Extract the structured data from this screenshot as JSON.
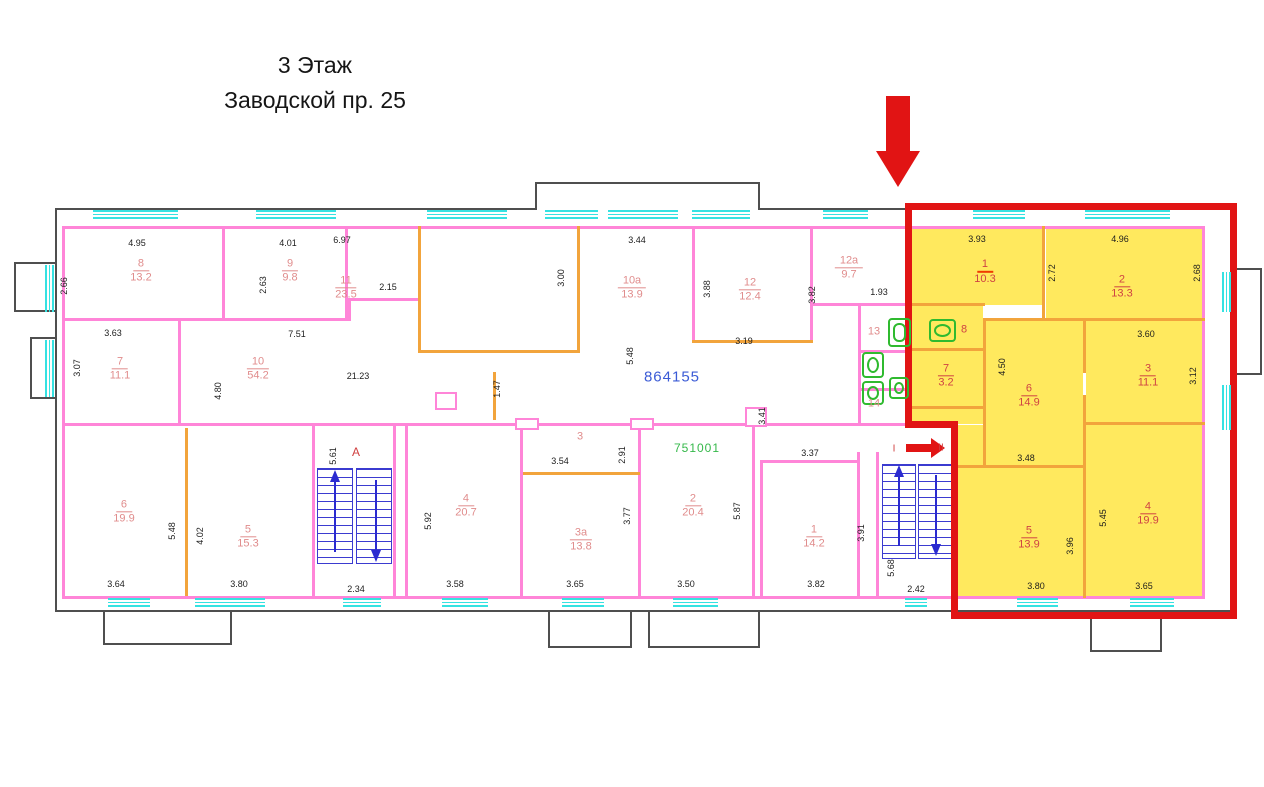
{
  "title": {
    "line1": "3 Этаж",
    "line2": "Заводской пр. 25"
  },
  "refs": {
    "blue": "864155",
    "green": "751001"
  },
  "rooms": [
    {
      "num": "8",
      "area": "13.2",
      "x": 141,
      "y": 271
    },
    {
      "num": "9",
      "area": "9.8",
      "x": 290,
      "y": 271
    },
    {
      "num": "11",
      "area": "23.5",
      "x": 346,
      "y": 288
    },
    {
      "num": "10а",
      "area": "13.9",
      "x": 632,
      "y": 288
    },
    {
      "num": "12",
      "area": "12.4",
      "x": 750,
      "y": 290
    },
    {
      "num": "12а",
      "area": "9.7",
      "x": 849,
      "y": 268
    },
    {
      "num": "13",
      "x": 874,
      "y": 332,
      "noline": true
    },
    {
      "num": "14",
      "x": 874,
      "y": 404,
      "noline": true
    },
    {
      "num": "7",
      "area": "11.1",
      "x": 120,
      "y": 369
    },
    {
      "num": "10",
      "area": "54.2",
      "x": 258,
      "y": 369
    },
    {
      "num": "6",
      "area": "19.9",
      "x": 124,
      "y": 512
    },
    {
      "num": "5",
      "area": "15.3",
      "x": 248,
      "y": 537
    },
    {
      "num": "4",
      "area": "20.7",
      "x": 466,
      "y": 506
    },
    {
      "num": "3",
      "x": 580,
      "y": 437,
      "noline": true
    },
    {
      "num": "3а",
      "area": "13.8",
      "x": 581,
      "y": 540
    },
    {
      "num": "2",
      "area": "20.4",
      "x": 693,
      "y": 506
    },
    {
      "num": "1",
      "area": "14.2",
      "x": 814,
      "y": 537
    },
    {
      "num": "1",
      "area": "10.3",
      "x": 985,
      "y": 272,
      "cls": "redl u-strong"
    },
    {
      "num": "2",
      "area": "13.3",
      "x": 1122,
      "y": 287,
      "cls": "redl"
    },
    {
      "num": "7",
      "area": "3.2",
      "x": 946,
      "y": 376,
      "cls": "redl"
    },
    {
      "num": "6",
      "area": "14.9",
      "x": 1029,
      "y": 396,
      "cls": "redl"
    },
    {
      "num": "3",
      "area": "11.1",
      "x": 1148,
      "y": 376,
      "cls": "redl"
    },
    {
      "num": "5",
      "area": "13.9",
      "x": 1029,
      "y": 538,
      "cls": "redl"
    },
    {
      "num": "4",
      "area": "19.9",
      "x": 1148,
      "y": 514,
      "cls": "redl"
    },
    {
      "num": "8",
      "x": 964,
      "y": 330,
      "noline": true,
      "cls": "redl"
    }
  ],
  "dims": [
    {
      "t": "4.95",
      "x": 137,
      "y": 243
    },
    {
      "t": "2.66",
      "x": 64,
      "y": 286,
      "v": true
    },
    {
      "t": "4.01",
      "x": 288,
      "y": 243
    },
    {
      "t": "2.63",
      "x": 263,
      "y": 285,
      "v": true
    },
    {
      "t": "2.15",
      "x": 388,
      "y": 287
    },
    {
      "t": "6.97",
      "x": 342,
      "y": 240
    },
    {
      "t": "3.00",
      "x": 561,
      "y": 278,
      "v": true
    },
    {
      "t": "3.44",
      "x": 637,
      "y": 240
    },
    {
      "t": "3.88",
      "x": 707,
      "y": 289,
      "v": true
    },
    {
      "t": "3.82",
      "x": 812,
      "y": 295,
      "v": true
    },
    {
      "t": "1.93",
      "x": 879,
      "y": 292
    },
    {
      "t": "3.19",
      "x": 744,
      "y": 341
    },
    {
      "t": "3.63",
      "x": 113,
      "y": 333
    },
    {
      "t": "3.07",
      "x": 77,
      "y": 368,
      "v": true
    },
    {
      "t": "7.51",
      "x": 297,
      "y": 334
    },
    {
      "t": "21.23",
      "x": 358,
      "y": 376
    },
    {
      "t": "4.80",
      "x": 218,
      "y": 391,
      "v": true
    },
    {
      "t": "5.48",
      "x": 630,
      "y": 356,
      "v": true
    },
    {
      "t": "1.47",
      "x": 497,
      "y": 389,
      "v": true
    },
    {
      "t": "3.41",
      "x": 762,
      "y": 416,
      "v": true
    },
    {
      "t": "3.37",
      "x": 810,
      "y": 453
    },
    {
      "t": "3.54",
      "x": 560,
      "y": 461
    },
    {
      "t": "2.91",
      "x": 622,
      "y": 455,
      "v": true
    },
    {
      "t": "3.77",
      "x": 627,
      "y": 516,
      "v": true
    },
    {
      "t": "5.92",
      "x": 428,
      "y": 521,
      "v": true
    },
    {
      "t": "5.48",
      "x": 172,
      "y": 531,
      "v": true
    },
    {
      "t": "4.02",
      "x": 200,
      "y": 536,
      "v": true
    },
    {
      "t": "5.61",
      "x": 333,
      "y": 456,
      "v": true
    },
    {
      "t": "3.64",
      "x": 116,
      "y": 584
    },
    {
      "t": "3.80",
      "x": 239,
      "y": 584
    },
    {
      "t": "2.34",
      "x": 356,
      "y": 589
    },
    {
      "t": "3.58",
      "x": 455,
      "y": 584
    },
    {
      "t": "3.65",
      "x": 575,
      "y": 584
    },
    {
      "t": "3.50",
      "x": 686,
      "y": 584
    },
    {
      "t": "3.82",
      "x": 816,
      "y": 584
    },
    {
      "t": "3.91",
      "x": 861,
      "y": 533,
      "v": true
    },
    {
      "t": "5.87",
      "x": 737,
      "y": 511,
      "v": true
    },
    {
      "t": "5.68",
      "x": 891,
      "y": 568,
      "v": true
    },
    {
      "t": "2.42",
      "x": 916,
      "y": 589
    },
    {
      "t": "3.93",
      "x": 977,
      "y": 239
    },
    {
      "t": "2.72",
      "x": 1052,
      "y": 273,
      "v": true
    },
    {
      "t": "4.96",
      "x": 1120,
      "y": 239
    },
    {
      "t": "2.68",
      "x": 1197,
      "y": 273,
      "v": true
    },
    {
      "t": "3.60",
      "x": 1146,
      "y": 334
    },
    {
      "t": "3.12",
      "x": 1193,
      "y": 376,
      "v": true
    },
    {
      "t": "4.50",
      "x": 1002,
      "y": 367,
      "v": true
    },
    {
      "t": "3.48",
      "x": 1026,
      "y": 458
    },
    {
      "t": "3.96",
      "x": 1070,
      "y": 546,
      "v": true
    },
    {
      "t": "5.45",
      "x": 1103,
      "y": 518,
      "v": true
    },
    {
      "t": "3.80",
      "x": 1036,
      "y": 586
    },
    {
      "t": "3.65",
      "x": 1144,
      "y": 586
    }
  ],
  "texts": [
    {
      "t": "А",
      "x": 356,
      "y": 452,
      "cls": "t-red"
    },
    {
      "t": "I",
      "x": 894,
      "y": 449,
      "cls": "t-red-sm"
    },
    {
      "t": "II",
      "x": 941,
      "y": 448,
      "cls": "t-red-sm"
    },
    {
      "t": "864155",
      "x": 672,
      "y": 377,
      "cls": "t-blue"
    },
    {
      "t": "751001",
      "x": 697,
      "y": 448,
      "cls": "t-green"
    }
  ],
  "windows": [
    {
      "x": 93,
      "y": 210,
      "w": 85
    },
    {
      "x": 256,
      "y": 210,
      "w": 80
    },
    {
      "x": 427,
      "y": 210,
      "w": 80
    },
    {
      "x": 545,
      "y": 210,
      "w": 53
    },
    {
      "x": 608,
      "y": 210,
      "w": 70
    },
    {
      "x": 692,
      "y": 210,
      "w": 58
    },
    {
      "x": 823,
      "y": 210,
      "w": 45
    },
    {
      "x": 973,
      "y": 210,
      "w": 52
    },
    {
      "x": 1085,
      "y": 210,
      "w": 85
    },
    {
      "x": 108,
      "y": 598,
      "w": 42
    },
    {
      "x": 195,
      "y": 598,
      "w": 70
    },
    {
      "x": 343,
      "y": 598,
      "w": 38
    },
    {
      "x": 442,
      "y": 598,
      "w": 46
    },
    {
      "x": 562,
      "y": 598,
      "w": 42
    },
    {
      "x": 673,
      "y": 598,
      "w": 45
    },
    {
      "x": 905,
      "y": 598,
      "w": 22
    },
    {
      "x": 1017,
      "y": 598,
      "w": 41
    },
    {
      "x": 1130,
      "y": 598,
      "w": 44
    },
    {
      "x": 45,
      "y": 265,
      "h": 47,
      "vert": true
    },
    {
      "x": 45,
      "y": 340,
      "h": 57,
      "vert": true
    },
    {
      "x": 1222,
      "y": 272,
      "h": 40,
      "vert": true
    },
    {
      "x": 1222,
      "y": 385,
      "h": 45,
      "vert": true
    }
  ],
  "fixtures": [
    {
      "x": 862,
      "y": 352,
      "w": 22,
      "h": 26,
      "kind": "toilet"
    },
    {
      "x": 862,
      "y": 381,
      "w": 22,
      "h": 24,
      "kind": "sink"
    },
    {
      "x": 888,
      "y": 318,
      "w": 23,
      "h": 29,
      "kind": "tub"
    },
    {
      "x": 889,
      "y": 377,
      "w": 20,
      "h": 22,
      "kind": "sink"
    },
    {
      "x": 929,
      "y": 319,
      "w": 27,
      "h": 23,
      "kind": "washer"
    }
  ],
  "colors": {
    "highlight": "#e11414",
    "flat_fill": "#ffe95e",
    "window": "#35e2e2",
    "inner_wall": "#ff85d8",
    "partition": "#f2a43c",
    "outer_wall": "#4f4f4f"
  }
}
